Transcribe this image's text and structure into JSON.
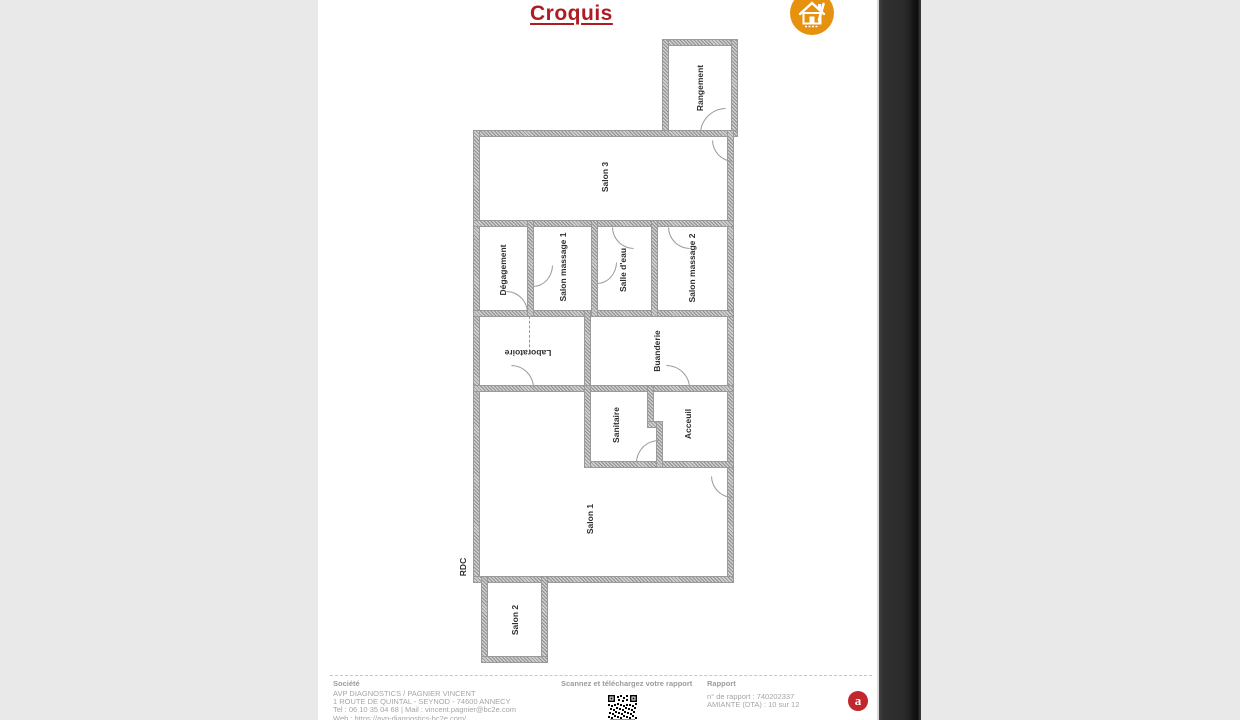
{
  "document": {
    "title": "Croquis",
    "floor_label": "RDC",
    "title_color": "#ae1c23",
    "logo_color": "#e6920e"
  },
  "plan": {
    "rooms": [
      {
        "name": "rangement",
        "label": "Rangement"
      },
      {
        "name": "salon-3",
        "label": "Salon 3"
      },
      {
        "name": "degagement",
        "label": "Dégagement"
      },
      {
        "name": "salon-massage-1",
        "label": "Salon massage 1"
      },
      {
        "name": "salle-deau",
        "label": "Salle d'eau"
      },
      {
        "name": "salon-massage-2",
        "label": "Salon massage 2"
      },
      {
        "name": "laboratoire",
        "label": "Laboratoire"
      },
      {
        "name": "buanderie",
        "label": "Buanderie"
      },
      {
        "name": "sanitaire",
        "label": "Sanitaire"
      },
      {
        "name": "acceuil",
        "label": "Acceuil"
      },
      {
        "name": "salon-1",
        "label": "Salon 1"
      },
      {
        "name": "salon-2",
        "label": "Salon 2"
      }
    ]
  },
  "footer": {
    "company": {
      "heading": "Société",
      "line1": "AVP DIAGNOSTICS / PAGNIER VINCENT",
      "line2": "1 ROUTE DE QUINTAL - SEYNOD - 74600 ANNECY",
      "line3": "Tel : 06 10 35 04 68 | Mail : vincent.pagnier@bc2e.com",
      "line4": "Web : https://avp-diagnostics-bc2e.com/"
    },
    "scan": {
      "heading": "Scannez et téléchargez votre rapport"
    },
    "report": {
      "heading": "Rapport",
      "line1": "n° de rapport : 740202337",
      "line2": "AMIANTE (DTA) : 10 sur 12"
    },
    "badge_letter": "a",
    "badge_color": "#c2272d"
  }
}
